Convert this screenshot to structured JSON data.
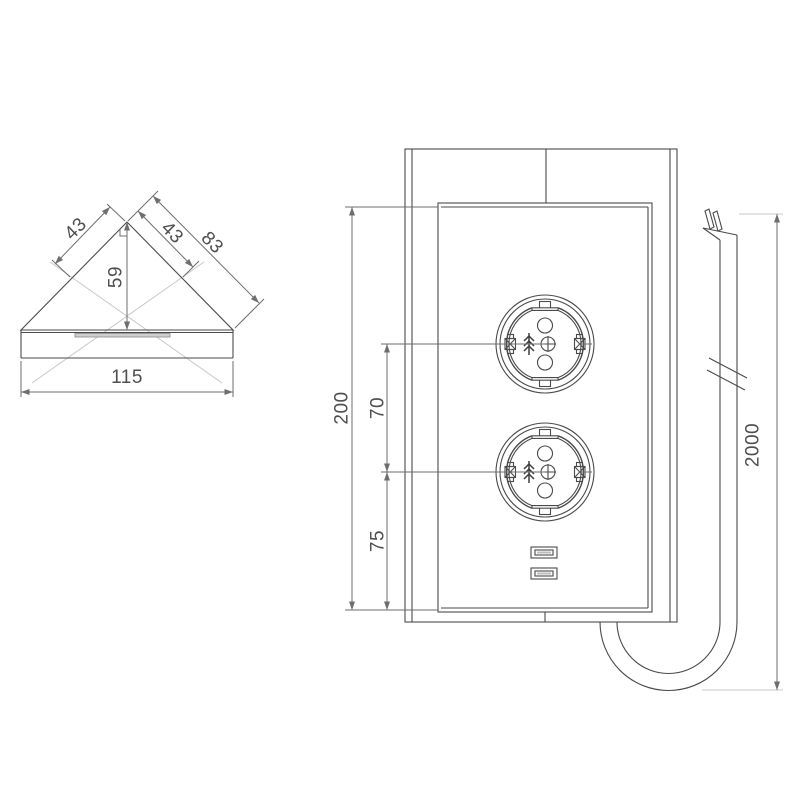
{
  "drawing_title": "corner-power-socket-technical-drawing",
  "dims": {
    "corner": {
      "edge_left": "43",
      "edge_right": "43",
      "edge_total": "83",
      "depth": "59",
      "width": "115"
    },
    "front": {
      "height": "200",
      "socket_spacing": "70",
      "socket_to_bottom": "75"
    },
    "cable": {
      "length": "2000"
    }
  },
  "colors": {
    "background": "#ffffff",
    "object_line": "#4a4a4a",
    "dimension_line": "#6e6e6e",
    "centerline": "#c9c9c9",
    "text": "#4f4f4f"
  },
  "symbols": {
    "socket": "schuko-socket-front",
    "usb": "usb-type-a-port",
    "cable_break": "double-slash-break-mark",
    "right_angle": "right-angle-mark",
    "centerlines": "crossed-centerlines"
  }
}
